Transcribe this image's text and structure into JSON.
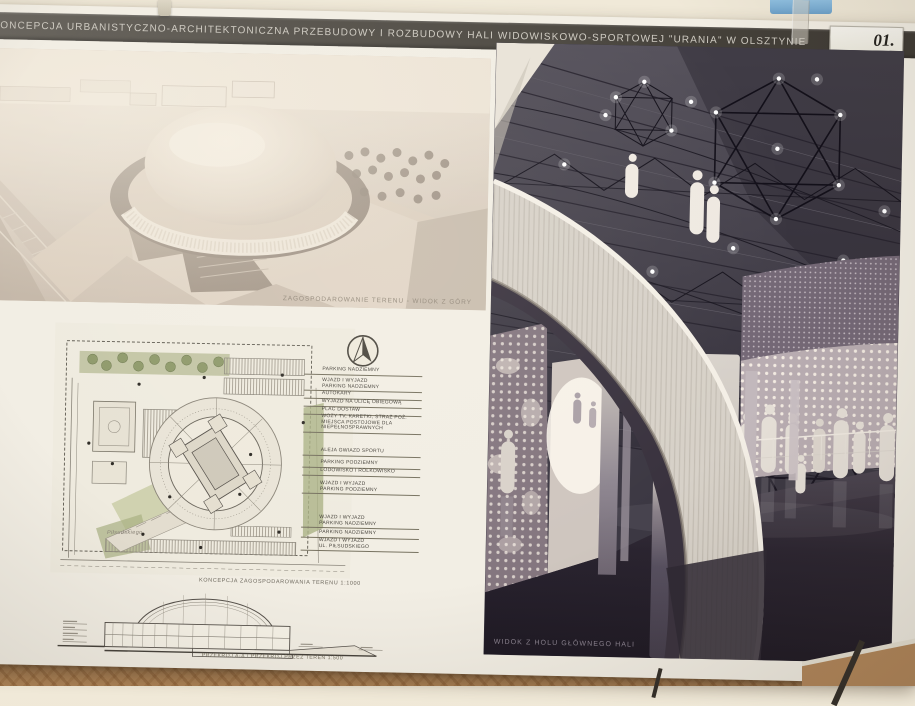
{
  "board": {
    "title": "KONCEPCJA URBANISTYCZNO-ARCHITEKTONICZNA PRZEBUDOWY I ROZBUDOWY HALI WIDOWISKOWO-SPORTOWEJ \"URANIA\" W OLSZTYNIE",
    "number": "01."
  },
  "panels": {
    "aerial": {
      "caption": "ZAGOSPODAROWANIE TERENU - WIDOK Z GÓRY"
    },
    "site_plan": {
      "caption": "KONCEPCJA ZAGOSPODAROWANIA TERENU 1:1000",
      "street_label": "Piłsudskiego",
      "annotations": [
        "PARKING NADZIEMNY",
        "WJAZD I WYJAZD\nPARKING NADZIEMNY",
        "AUTOKARY",
        "WYJAZD NA ULICĘ OBIEGOWĄ",
        "PLAC DOSTAW",
        "WOZY TV, KARETKI, STRAŻ POŻ.\nMIEJSCA POSTOJOWE DLA\nNIEPEŁNOSPRAWNYCH",
        "ALEJA GWIAZD SPORTU",
        "PARKING PODZIEMNY",
        "LODOWISKO I ROLKOWISKO",
        "WJAZD I WYJAZD\nPARKING PODZIEMNY",
        "WJAZD I WYJAZD\nPARKING NADZIEMNY",
        "PARKING NADZIEMNY",
        "WJAZD I WYJAZD\nUL. PIŁSUDSKIEGO"
      ]
    },
    "section": {
      "caption": "PRZEKRÓJ A-A / PRZEKRÓJ PRZEZ TEREN 1:500"
    },
    "interior": {
      "caption": "WIDOK Z HOLU GŁÓWNEGO HALI"
    }
  },
  "colors": {
    "title_band": "#4a463f",
    "board": "#f2eee4",
    "wall": "#ece4d1",
    "carpet": "#b5895a",
    "interior_ceiling": "#45414b",
    "interior_floor": "#2a2430",
    "plan_green": "#aeb388",
    "render_sepia": "#d8ccbd"
  }
}
